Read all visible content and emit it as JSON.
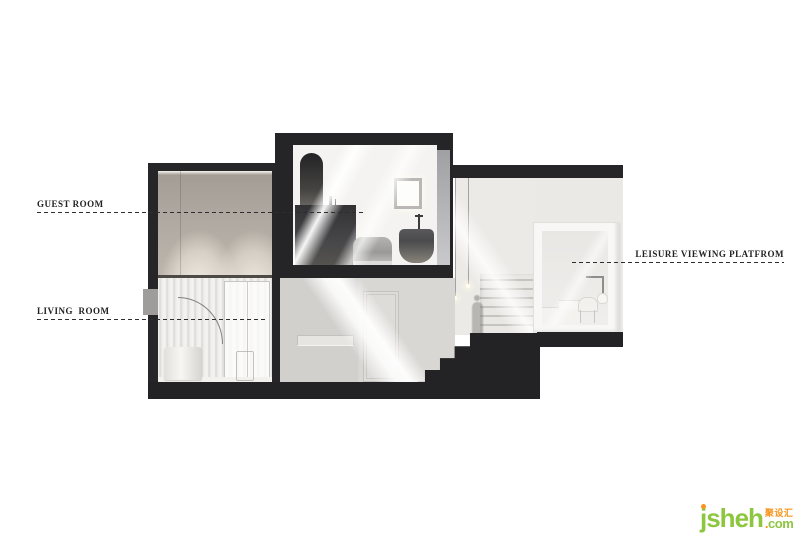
{
  "annotations": {
    "guest_room": "GUEST ROOM",
    "living_room": "LIVING  ROOM",
    "leisure_platform": "LEISURE VIEWING PLATFROM"
  },
  "logo": {
    "brand": "jsheh",
    "cn": "聚设汇",
    "tld_dot": ".",
    "tld": "com",
    "brand_color": "#8dc63f",
    "accent_color": "#f7941d"
  },
  "colors": {
    "structure_dark": "#262628",
    "base_dark": "#232325",
    "background": "#ffffff",
    "label_text": "#222222"
  }
}
